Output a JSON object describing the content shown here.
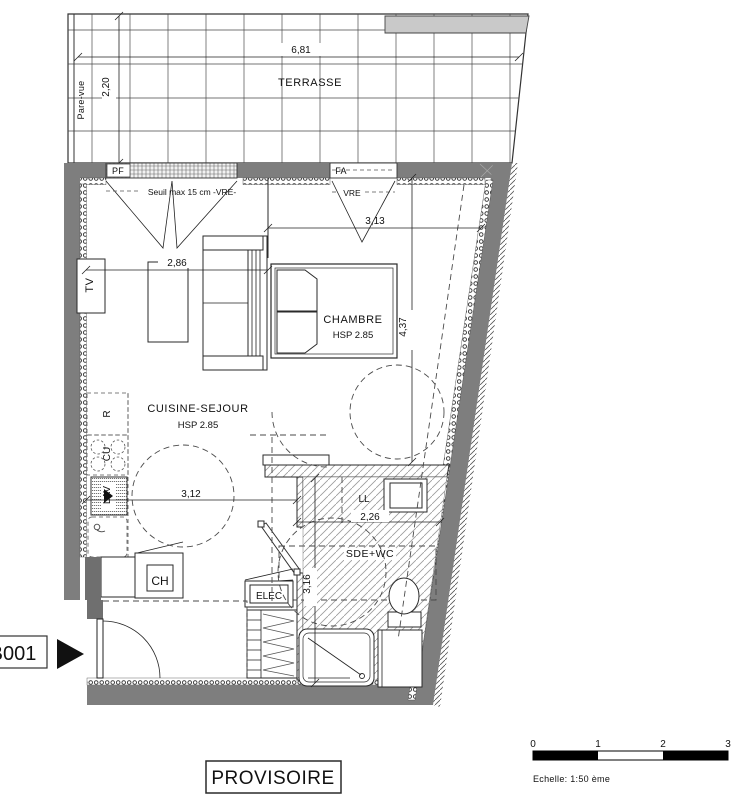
{
  "plan": {
    "terrace": {
      "label": "TERRASSE",
      "width_dim": "6,81",
      "depth_dim": "2,20",
      "screen_label": "Pare-vue"
    },
    "windows": {
      "pf_label": "PF",
      "fa_label": "FA",
      "vre_label": "VRE",
      "seuil_note": "Seuil max 15 cm -VRE-"
    },
    "rooms": {
      "chambre": {
        "name": "CHAMBRE",
        "hsp": "HSP 2.85"
      },
      "cuisine": {
        "name": "CUISINE-SEJOUR",
        "hsp": "HSP 2.85"
      },
      "sde": {
        "name": "SDE+WC"
      }
    },
    "dims": {
      "chambre_w": "3,13",
      "sejour_w": "2,86",
      "chambre_h": "4,37",
      "kitchen_w": "3,12",
      "sde_w": "2,26",
      "sde_h": "3,16"
    },
    "equipment": {
      "tv": "TV",
      "fridge": "R",
      "hob": "CU",
      "dishwasher": "LAV",
      "boiler": "CH",
      "elec": "ELEC",
      "washer": "LL"
    },
    "unit_label": "B001",
    "stamp": "PROVISOIRE",
    "scalebar": {
      "ticks": [
        "0",
        "1",
        "2",
        "3"
      ],
      "caption": "Echelle: 1:50 ème"
    }
  }
}
